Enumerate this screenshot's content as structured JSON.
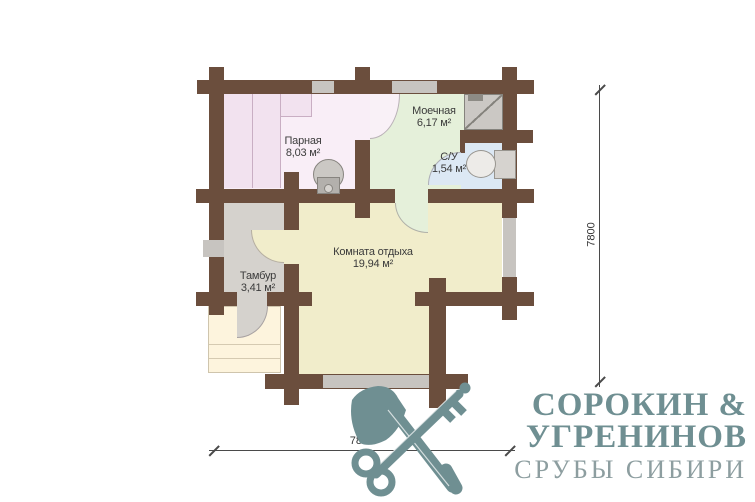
{
  "plan": {
    "rooms": [
      {
        "name": "Парная",
        "area": "8,03 м²"
      },
      {
        "name": "Моечная",
        "area": "6,17 м²"
      },
      {
        "name": "С/У",
        "area": "1,54 м²"
      },
      {
        "name": "Комната отдыха",
        "area": "19,94 м²"
      },
      {
        "name": "Тамбур",
        "area": "3,41 м²"
      }
    ],
    "dimensions": {
      "horizontal": "7800",
      "vertical": "7800"
    },
    "fixtures": [
      "stove-icon",
      "shower-icon",
      "toilet-icon"
    ]
  },
  "logo": {
    "line1": "СОРОКИН &",
    "line2": "УГРЕНИНОВ",
    "line3": "СРУБЫ СИБИРИ",
    "icon": "crossed-axe-and-key-icon"
  },
  "colors": {
    "background": "#ffffff",
    "wall": "#6b4e3d",
    "window": "#c7c4c0",
    "parnaya_floor": "#f9eef7",
    "bench": "#f2e2ef",
    "moechnaya_floor": "#e5f0da",
    "su_floor": "#dce8f4",
    "komnata_floor": "#f1edcb",
    "tambur_floor": "#d5d2cd",
    "porch_floor": "#fdf4dd",
    "fixture_gray": "#cbc8c4",
    "dimension_line": "#4a4a4a",
    "label_text": "#3b3b3b",
    "logo_teal": "#6f8f92",
    "logo_tagline": "#8d9ea0"
  }
}
